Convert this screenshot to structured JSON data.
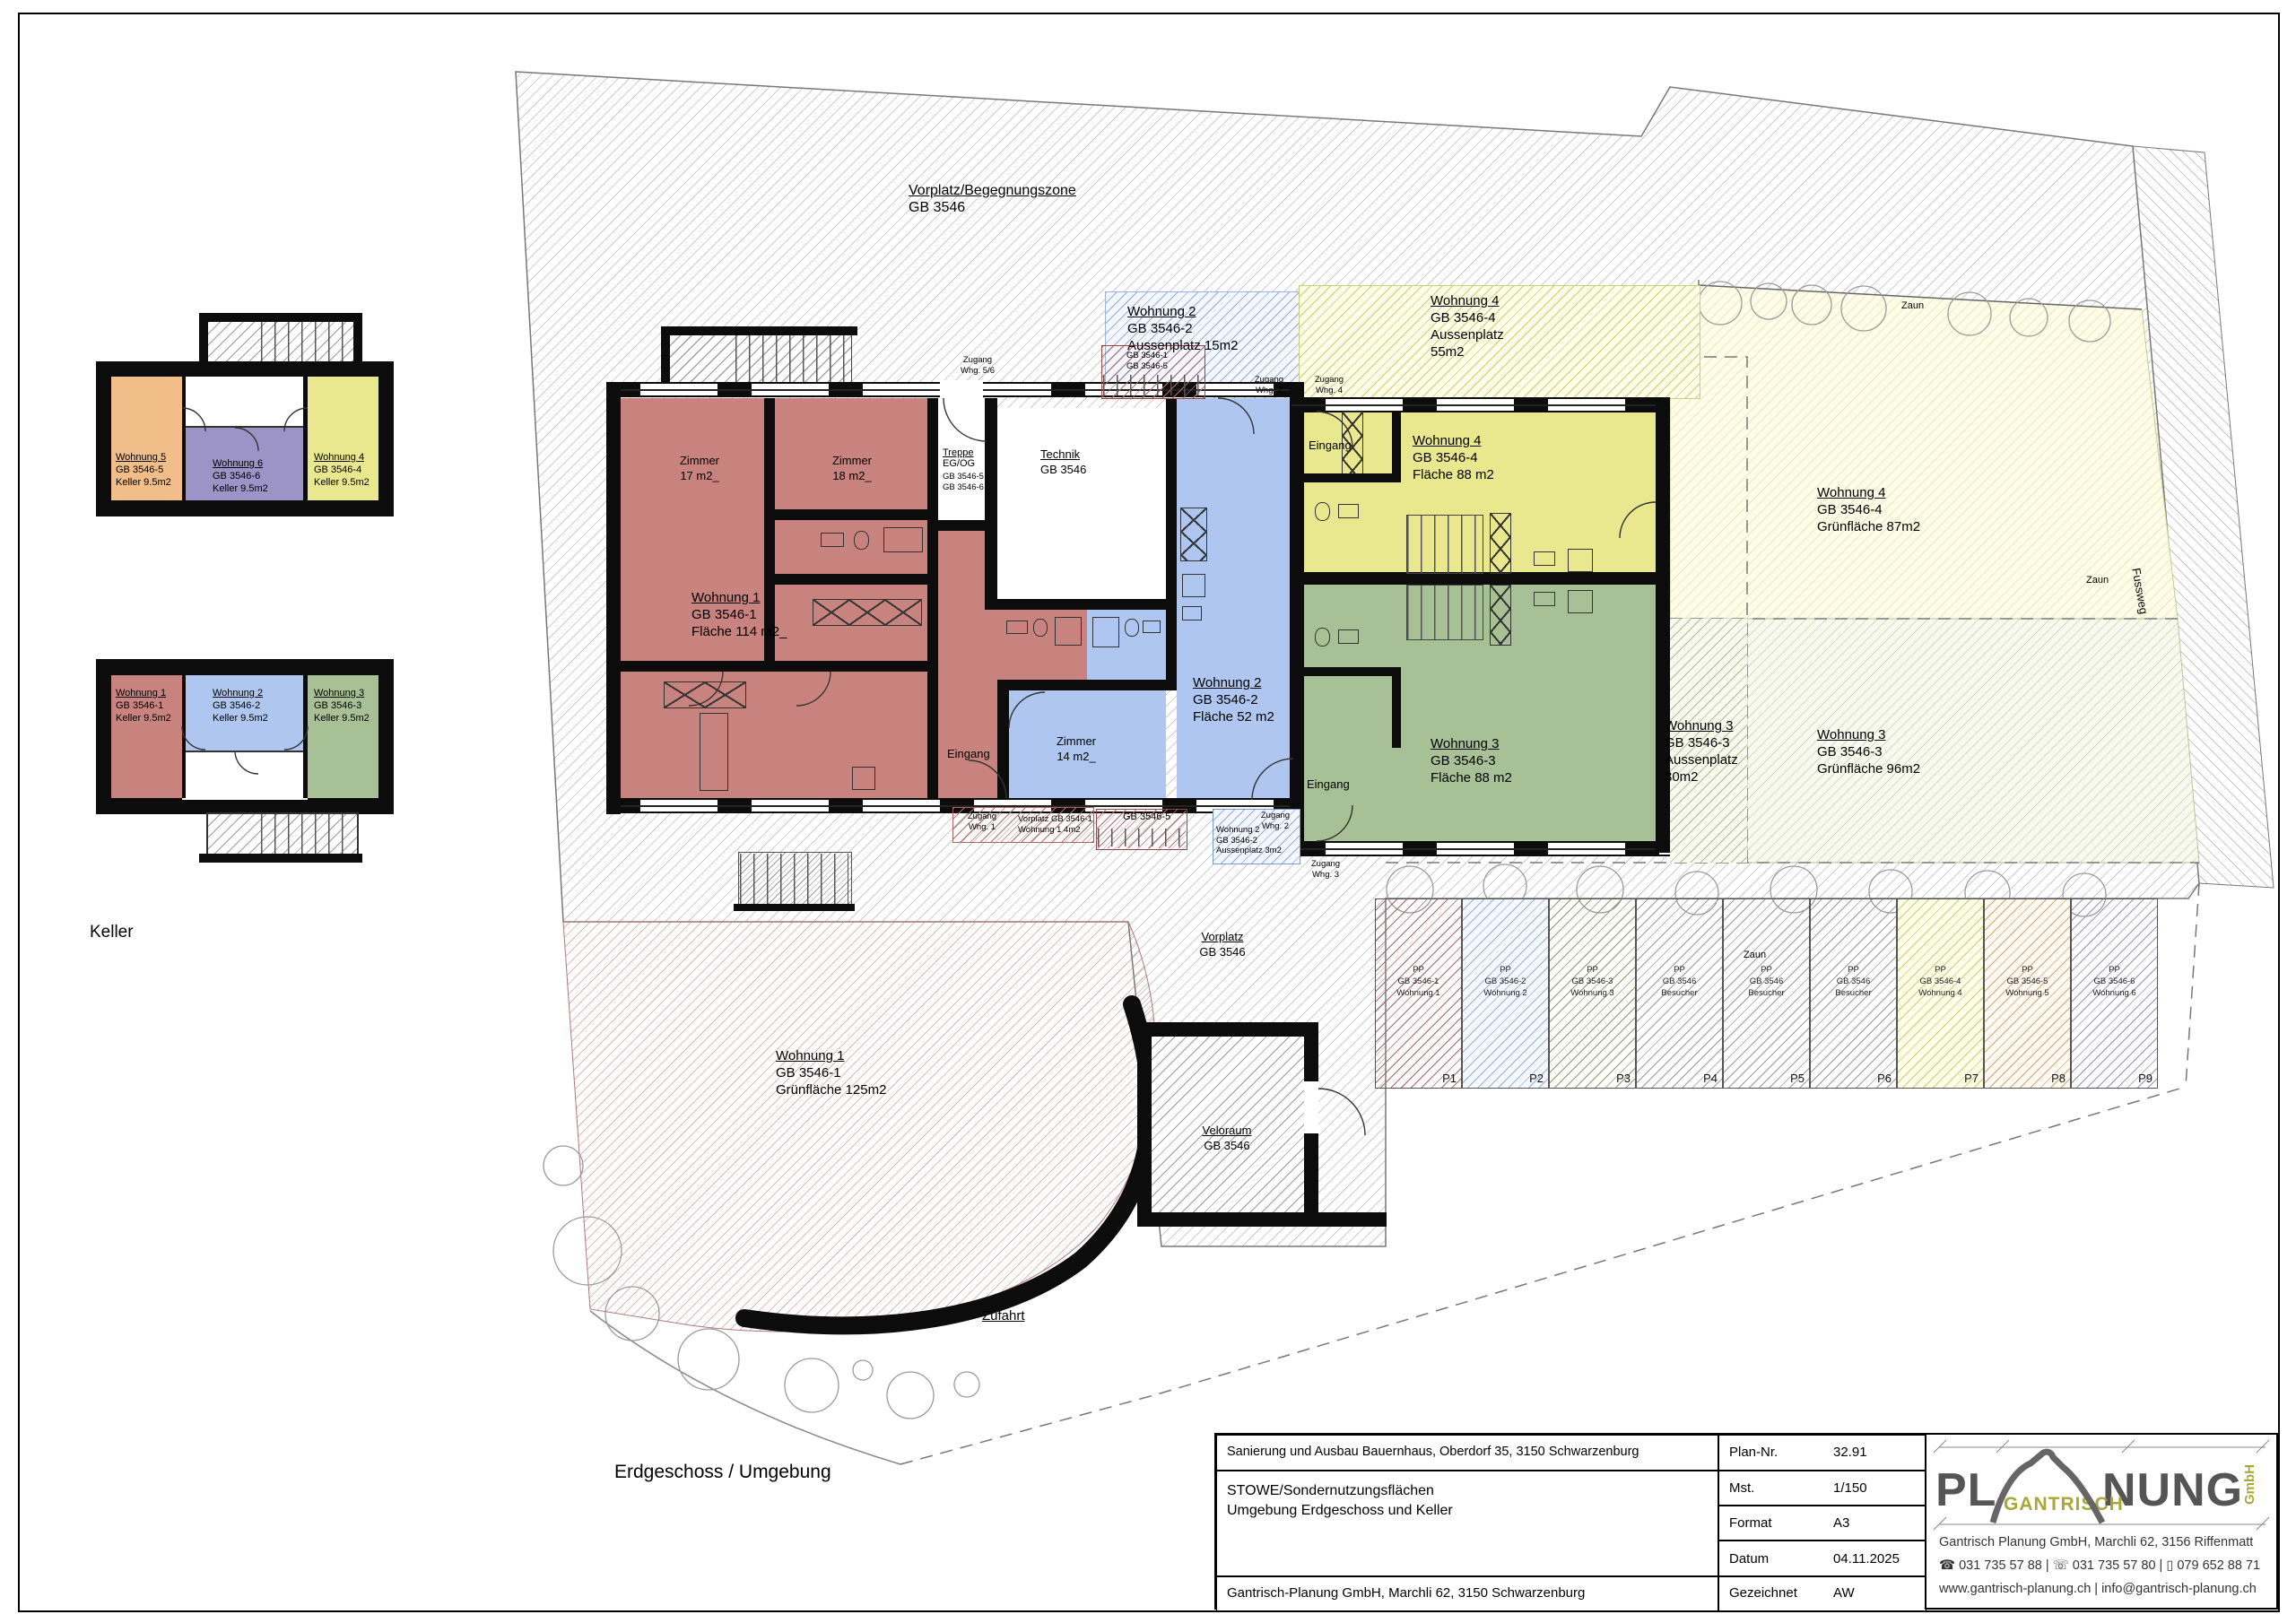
{
  "sheet": {
    "floor_title": "Erdgeschoss / Umgebung",
    "keller_title": "Keller"
  },
  "keller_upper": {
    "units": [
      {
        "name": "Wohnung 5",
        "gb": "GB 3546-5",
        "area": "Keller 9.5m2"
      },
      {
        "name": "Wohnung 6",
        "gb": "GB 3546-6",
        "area": "Keller 9.5m2"
      },
      {
        "name": "Wohnung 4",
        "gb": "GB 3546-4",
        "area": "Keller 9.5m2"
      }
    ]
  },
  "keller_lower": {
    "units": [
      {
        "name": "Wohnung 1",
        "gb": "GB 3546-1",
        "area": "Keller 9.5m2"
      },
      {
        "name": "Wohnung 2",
        "gb": "GB 3546-2",
        "area": "Keller 9.5m2"
      },
      {
        "name": "Wohnung 3",
        "gb": "GB 3546-3",
        "area": "Keller 9.5m2"
      }
    ]
  },
  "zones": {
    "begegnung": {
      "l1": "Vorplatz/Begegnungszone",
      "l2": "GB 3546"
    },
    "w2a": {
      "l1": "Wohnung 2",
      "l2": "GB 3546-2",
      "l3": "Aussenplatz 15m2"
    },
    "st_top": {
      "l1": "GB 3546-1",
      "l2": "GB 3546-5"
    },
    "w4a": {
      "l1": "Wohnung 4",
      "l2": "GB 3546-4",
      "l3": "Aussenplatz",
      "l4": "55m2"
    },
    "w4g": {
      "l1": "Wohnung 4",
      "l2": "GB 3546-4",
      "l3": "Grünfläche 87m2"
    },
    "w3a": {
      "l1": "Wohnung 3",
      "l2": "GB 3546-3",
      "l3": "Aussenplatz",
      "l4": "30m2"
    },
    "w3g": {
      "l1": "Wohnung 3",
      "l2": "GB 3546-3",
      "l3": "Grünfläche 96m2"
    },
    "w1g": {
      "l1": "Wohnung 1",
      "l2": "GB 3546-1",
      "l3": "Grünfläche 125m2"
    },
    "vorplatz": {
      "l1": "Vorplatz",
      "l2": "GB 3546"
    },
    "veloraum": {
      "l1": "Veloraum",
      "l2": "GB 3546"
    },
    "zufahrt": "Zufahrt",
    "vorplatz_w1": {
      "l1": "Vorplatz GB 3546-1",
      "l2": "Wohnung 1 4m2"
    },
    "st_bottom": "GB 3546-5",
    "w2a3": {
      "l1": "Woh­nung 2",
      "l2": "GB 3546-2",
      "l3": "Aussenplatz 3m2"
    }
  },
  "rooms": {
    "technik": {
      "l1": "Technik",
      "l2": "GB 3546"
    },
    "treppe": {
      "l1": "Treppe",
      "l2": "EG/OG",
      "l3": "GB 3546-5",
      "l4": "GB 3546-6"
    },
    "w1": {
      "l1": "Wohnung 1",
      "l2": "GB 3546-1",
      "l3": "Fläche 114 m2_"
    },
    "w2": {
      "l1": "Wohnung 2",
      "l2": "GB 3546-2",
      "l3": "Fläche 52 m2"
    },
    "w3": {
      "l1": "Wohnung 3",
      "l2": "GB 3546-3",
      "l3": "Fläche 88 m2"
    },
    "w4": {
      "l1": "Wohnung 4",
      "l2": "GB 3546-4",
      "l3": "Fläche 88 m2"
    },
    "z17": {
      "l1": "Zimmer",
      "l2": "17 m2_"
    },
    "z18": {
      "l1": "Zimmer",
      "l2": "18 m2_"
    },
    "z14": {
      "l1": "Zimmer",
      "l2": "14 m2_"
    },
    "eingang": "Eingang"
  },
  "access": {
    "zg56": {
      "l1": "Zugang",
      "l2": "Whg. 5/6"
    },
    "zg2t": {
      "l1": "Zugang",
      "l2": "Whg. 2"
    },
    "zg4t": {
      "l1": "Zugang",
      "l2": "Whg. 4"
    },
    "zg1b": {
      "l1": "Zugang",
      "l2": "Whg. 1"
    },
    "zg2b": {
      "l1": "Zugang",
      "l2": "Whg. 2"
    },
    "zg3b": {
      "l1": "Zugang",
      "l2": "Whg. 3"
    }
  },
  "boundary": {
    "zaun": "Zaun",
    "fussweg": "Fussweg"
  },
  "parking": {
    "stalls": [
      {
        "l1": "PP",
        "l2": "GB 3546-1",
        "l3": "Wohnung 1",
        "p": "P1",
        "hatch": "#b06060"
      },
      {
        "l1": "PP",
        "l2": "GB 3546-2",
        "l3": "Wohnung 2",
        "p": "P2",
        "hatch": "#8fb0dd"
      },
      {
        "l1": "PP",
        "l2": "GB 3546-3",
        "l3": "Wohnung 3",
        "p": "P3",
        "hatch": "#8f9a68"
      },
      {
        "l1": "PP",
        "l2": "GB 3546",
        "l3": "Besucher",
        "p": "P4",
        "hatch": "#9a9a9a"
      },
      {
        "l1": "PP",
        "l2": "GB 3546",
        "l3": "Besucher",
        "p": "P5",
        "hatch": "#9a9a9a"
      },
      {
        "l1": "PP",
        "l2": "GB 3546",
        "l3": "Besucher",
        "p": "P6",
        "hatch": "#9a9a9a"
      },
      {
        "l1": "PP",
        "l2": "GB 3546-4",
        "l3": "Wohnung 4",
        "p": "P7",
        "hatch": "#cdcd66"
      },
      {
        "l1": "PP",
        "l2": "GB 3546-5",
        "l3": "Wohnung 5",
        "p": "P8",
        "hatch": "#d7a468"
      },
      {
        "l1": "PP",
        "l2": "GB 3546-6",
        "l3": "Wohnung 6",
        "p": "P9",
        "hatch": "#9690bd"
      }
    ]
  },
  "titleblock": {
    "project": "Sanierung und Ausbau Bauernhaus, Oberdorf 35, 3150 Schwarzenburg",
    "subject1": "STOWE/Sondernutzungsflächen",
    "subject2": "Umgebung Erdgeschoss und Keller",
    "company": "Gantrisch-Planung GmbH, Marchli 62, 3150 Schwarzenburg",
    "plannr_label": "Plan-Nr.",
    "plannr": "32.91",
    "mst_label": "Mst.",
    "mst": "1/150",
    "format_label": "Format",
    "format": "A3",
    "datum_label": "Datum",
    "datum": "04.11.2025",
    "gez_label": "Gezeichnet",
    "gez": "AW"
  },
  "logo": {
    "pl": "PL",
    "nung": "NUNG",
    "gantrisch": "GANTRISCH",
    "gmbh": "GmbH",
    "address": "Gantrisch Planung GmbH, Marchli 62, 3156 Riffenmatt",
    "phones": "☎ 031 735 57 88  |  ☏ 031 735 57 80  |  ▯ 079 652 88 71",
    "web": "www.gantrisch-planung.ch  |  info@gantrisch-planung.ch"
  },
  "colors": {
    "unit_red": "#c9837f",
    "unit_blue": "#aec6f0",
    "unit_yellow": "#e9e88f",
    "unit_green": "#a7c096",
    "unit_orange": "#f1bd88",
    "unit_purple": "#9c93c6",
    "wall": "#0c0c0c",
    "site_hatch": "#9a9a9a"
  }
}
